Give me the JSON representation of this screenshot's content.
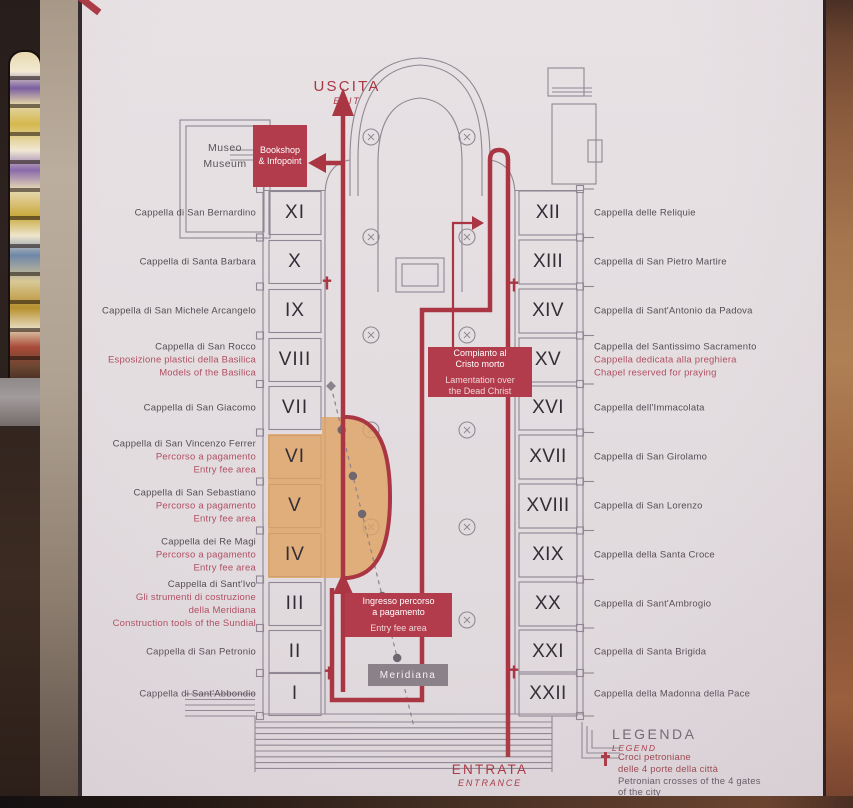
{
  "colors": {
    "accent_red": "#a93642",
    "box_red": "#b23c4c",
    "orange_area": "#dfa365",
    "plan_gray": "#8f8793",
    "label_dark": "#544d54",
    "label_pink": "#b04f63",
    "meridiana_gray": "#8b8289"
  },
  "top": {
    "uscita": "USCITA",
    "exit": "EXIT",
    "museo_it": "Museo",
    "museo_en": "Museum",
    "bookshop": "Bookshop\n& Infopoint"
  },
  "bottom": {
    "entrata": "ENTRATA",
    "entrance": "ENTRANCE"
  },
  "boxes": {
    "compianto_it": "Compianto al\nCristo morto",
    "compianto_en": "Lamentation over\nthe Dead Christ",
    "ingresso_it": "Ingresso percorso\na pagamento",
    "ingresso_en": "Entry fee area",
    "meridiana": "Meridiana"
  },
  "legend": {
    "title_it": "LEGENDA",
    "title_en": "LEGEND",
    "cross_it": "Croci petroniane\ndelle 4 porte della città",
    "cross_en": "Petronian crosses of the 4 gates\nof the city"
  },
  "chapels_left": [
    {
      "numeral": "XI",
      "name": "Cappella di San Bernardino",
      "sub": ""
    },
    {
      "numeral": "X",
      "name": "Cappella di Santa Barbara",
      "sub": ""
    },
    {
      "numeral": "IX",
      "name": "Cappella di San Michele Arcangelo",
      "sub": ""
    },
    {
      "numeral": "VIII",
      "name": "Cappella di San Rocco",
      "sub": "Esposizione plastici della Basilica\nModels of the Basilica"
    },
    {
      "numeral": "VII",
      "name": "Cappella di San Giacomo",
      "sub": ""
    },
    {
      "numeral": "VI",
      "name": "Cappella di San Vincenzo Ferrer",
      "sub": "Percorso a pagamento\nEntry fee area"
    },
    {
      "numeral": "V",
      "name": "Cappella di San Sebastiano",
      "sub": "Percorso a pagamento\nEntry fee area"
    },
    {
      "numeral": "IV",
      "name": "Cappella dei Re Magi",
      "sub": "Percorso a pagamento\nEntry fee area"
    },
    {
      "numeral": "III",
      "name": "Cappella di Sant'Ivo",
      "sub": "Gli strumenti di costruzione\ndella Meridiana\nConstruction tools of the Sundial"
    },
    {
      "numeral": "II",
      "name": "Cappella di San Petronio",
      "sub": ""
    },
    {
      "numeral": "I",
      "name": "Cappella di Sant'Abbondio",
      "sub": ""
    }
  ],
  "chapels_right": [
    {
      "numeral": "XII",
      "name": "Cappella delle Reliquie",
      "sub": ""
    },
    {
      "numeral": "XIII",
      "name": "Cappella di San Pietro Martire",
      "sub": ""
    },
    {
      "numeral": "XIV",
      "name": "Cappella di Sant'Antonio da Padova",
      "sub": ""
    },
    {
      "numeral": "XV",
      "name": "Cappella del Santissimo Sacramento",
      "sub": "Cappella dedicata alla preghiera\nChapel reserved for praying"
    },
    {
      "numeral": "XVI",
      "name": "Cappella dell'Immacolata",
      "sub": ""
    },
    {
      "numeral": "XVII",
      "name": "Cappella di San Girolamo",
      "sub": ""
    },
    {
      "numeral": "XVIII",
      "name": "Cappella di San Lorenzo",
      "sub": ""
    },
    {
      "numeral": "XIX",
      "name": "Cappella della Santa Croce",
      "sub": ""
    },
    {
      "numeral": "XX",
      "name": "Cappella di Sant'Ambrogio",
      "sub": ""
    },
    {
      "numeral": "XXI",
      "name": "Cappella di Santa Brigida",
      "sub": ""
    },
    {
      "numeral": "XXII",
      "name": "Cappella della Madonna della Pace",
      "sub": ""
    }
  ]
}
